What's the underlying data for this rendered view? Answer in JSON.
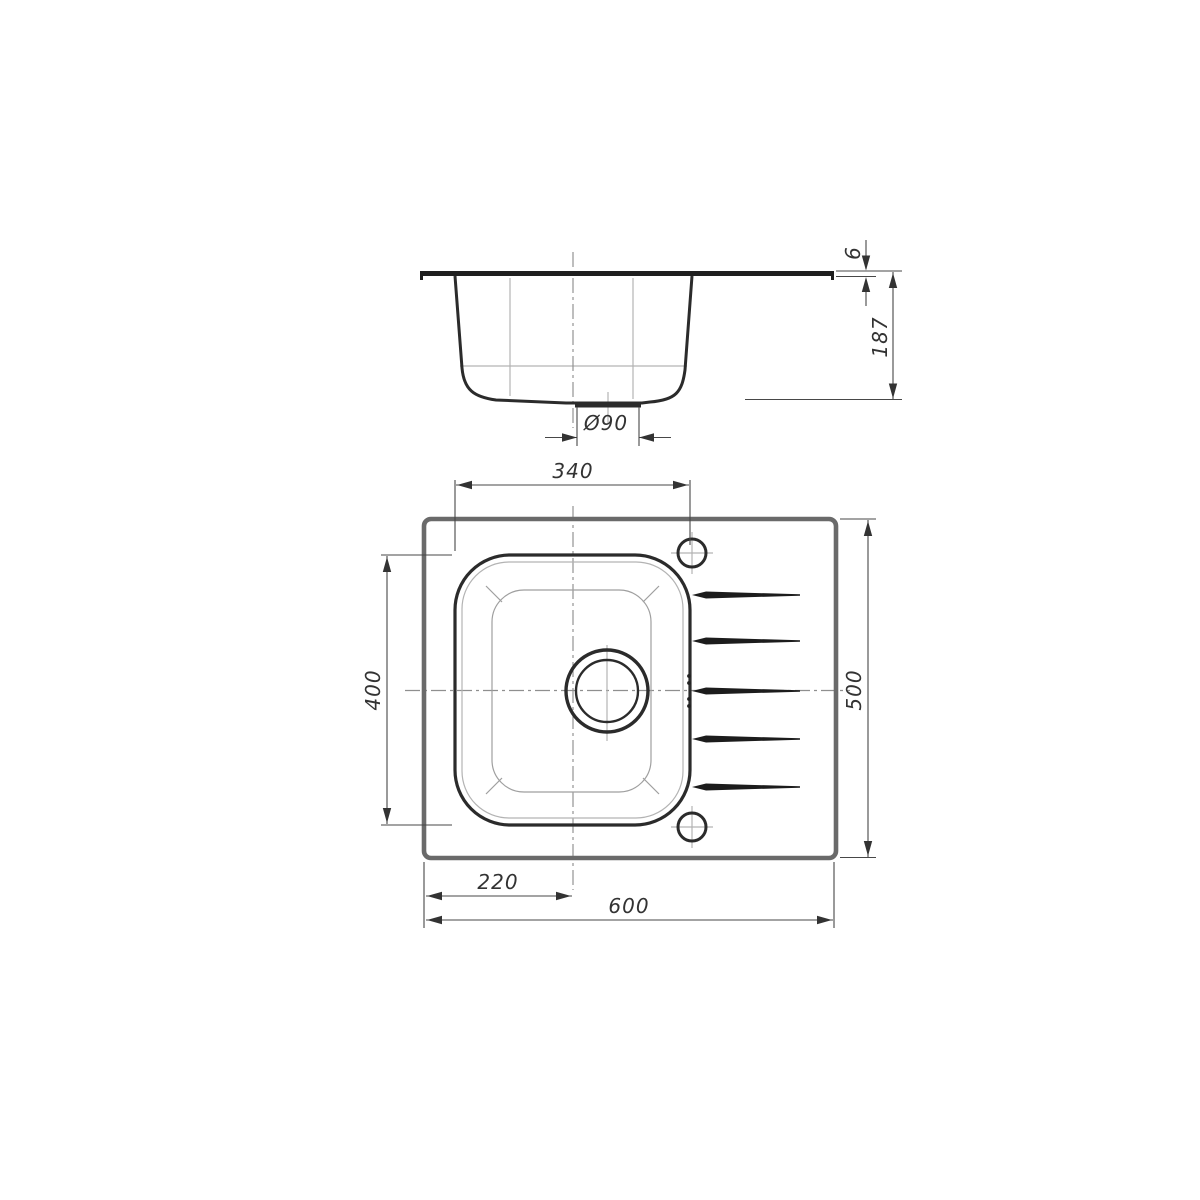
{
  "drawing": {
    "subject": "Kitchen sink with single bowl and drainer - dimensioned technical drawing, side section view above plan view",
    "views": {
      "side": {
        "name": "side-section-view",
        "dims": {
          "rim_height": {
            "label": "6"
          },
          "bowl_depth": {
            "label": "187"
          },
          "drain_diameter": {
            "label": "Ø90"
          }
        }
      },
      "top": {
        "name": "plan-view",
        "dims": {
          "bowl_width": {
            "label": "340"
          },
          "bowl_length": {
            "label": "400"
          },
          "overall_depth": {
            "label": "500"
          },
          "bowl_center_offset": {
            "label": "220"
          },
          "overall_width": {
            "label": "600"
          }
        }
      }
    },
    "colors": {
      "background": "#ffffff",
      "outline": "#2b2b2b",
      "panel_edge": "#6a6a6a",
      "dimension_lines": "#474747",
      "construction_lines": "#b3b3b3",
      "centerlines": "#8f8f8f"
    }
  }
}
